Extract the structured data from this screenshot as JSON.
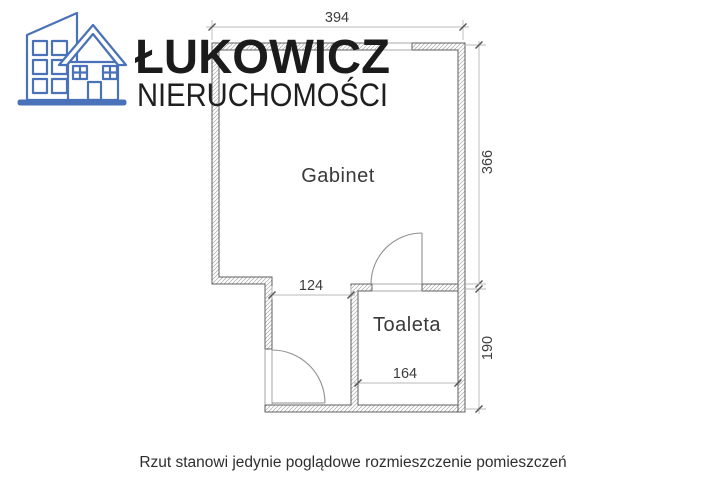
{
  "logo": {
    "brand": "ŁUKOWICZ",
    "subtitle": "NIERUCHOMOŚCI",
    "icon": "buildings-icon",
    "accent_color": "#4a72b8"
  },
  "floorplan": {
    "rooms": [
      {
        "name": "Gabinet"
      },
      {
        "name": "Toaleta"
      }
    ],
    "dimensions": {
      "top_width": "394",
      "right_upper_height": "366",
      "right_lower_height": "190",
      "corridor_width": "124",
      "toaleta_width": "164"
    }
  },
  "footer": {
    "disclaimer": "Rzut stanowi jedynie poglądowe rozmieszczenie pomieszczeń"
  },
  "colors": {
    "wall_outline": "#5f5f5f",
    "wall_hatch": "#ababab",
    "dimension_line": "#b8b8b8",
    "label_text": "#3a3a3a",
    "logo_blue": "#4a72b8",
    "brand_text": "#1b1b1b"
  }
}
